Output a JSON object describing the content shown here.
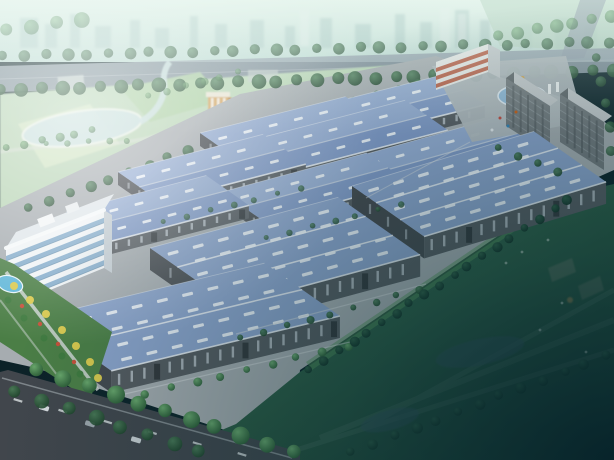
{
  "palette": {
    "sky_top": "#dcede6",
    "sky_mid": "#c0dcd5",
    "city_block": "#9fc0bd",
    "city_tower": "#e4eeea",
    "road_top": "#93a0ac",
    "road_median": "#b3bcc4",
    "road_asphalt": "#41464c",
    "lane_dash": "#d5dadc",
    "curb": "#d8dcdf",
    "park_base": "#b7d4b4",
    "field_pale": "#cfe3c0",
    "field_mid": "#a9cd9f",
    "field_light": "#dcead0",
    "lake": "#c6dedd",
    "shore": "#e9f1e7",
    "park_path": "#d5ddd3",
    "tower_front": "#d2a159",
    "tower_side": "#b5813f",
    "ground": "#a6acb0",
    "plaza": "#b2b9be",
    "roof_light": "#95acd2",
    "roof_dark": "#8099c6",
    "roof_big": "#8ba3cb",
    "roof_line": "#e8edf3",
    "ridge": "#c3cfe0",
    "skylight": "#eef3f9",
    "wall": "#565b60",
    "wall_dark": "#45494e",
    "wall_window": "#b6bec6",
    "door": "#34383c",
    "lawn_hi": "#549158",
    "lawn_light": "#4c8852",
    "lawn_mid": "#2d5c44",
    "lawn_dark": "#123129",
    "hq_white": "#eff3f5",
    "hq_glass": "#7fa9c8",
    "hq_glass_line": "#5e87a5",
    "hq_side": "#c5ced4",
    "hq_roof": "#dfe6ea",
    "entrance_white": "#e9eae8",
    "entrance_red": "#bb6047",
    "entrance_roof": "#d8dcde",
    "entrance_side": "#c4c9cc",
    "dorm_front": "#72787c",
    "dorm_side": "#5e6468",
    "dorm_roof": "#c3c7ca",
    "dorm_line": "#8e969b",
    "dorm_window": "#565c60",
    "fountain_ring": "#8fb8d8",
    "fountain_water": "#aecde6",
    "fountain_gold": "#cfa34f",
    "pool": "#5fb6d8",
    "garden": "#4b7e46",
    "walkway": "#cdd4d1",
    "tree_yellow": "#d9c94e",
    "tree_red": "#c7503a",
    "tree_green": "#3f7a3f",
    "pond_dark": "#2e5056",
    "hint_bldg": "#5f6f5f",
    "hint_orange": "#b98a4f",
    "dark_corner": "#05202a"
  },
  "background": {
    "city_blocks": [
      [
        20,
        18,
        18,
        30
      ],
      [
        45,
        24,
        12,
        24
      ],
      [
        70,
        14,
        10,
        34
      ],
      [
        95,
        26,
        16,
        22
      ],
      [
        130,
        20,
        10,
        28
      ],
      [
        155,
        28,
        14,
        20
      ],
      [
        190,
        16,
        8,
        32
      ],
      [
        215,
        24,
        12,
        24
      ],
      [
        250,
        20,
        14,
        28
      ],
      [
        285,
        26,
        10,
        22
      ],
      [
        320,
        18,
        12,
        30
      ],
      [
        355,
        24,
        16,
        24
      ],
      [
        395,
        14,
        10,
        34
      ],
      [
        420,
        22,
        12,
        26
      ],
      [
        455,
        10,
        14,
        38
      ],
      [
        480,
        20,
        10,
        28
      ],
      [
        520,
        24,
        12,
        24
      ],
      [
        555,
        18,
        14,
        30
      ],
      [
        585,
        26,
        12,
        22
      ]
    ],
    "city_towers": [
      [
        440,
        8,
        10,
        40
      ],
      [
        458,
        14,
        8,
        34
      ],
      [
        300,
        10,
        9,
        36
      ]
    ]
  },
  "park": {
    "fields": [
      {
        "pts": "18,124 90,104 120,144 45,168",
        "color": "field_pale"
      },
      {
        "pts": "120,88 200,72 225,100 150,122",
        "color": "field_mid"
      },
      {
        "pts": "175,132 260,110 285,152 200,176",
        "color": "field_light"
      }
    ],
    "lake": {
      "cx": 82,
      "cy": 128,
      "rx": 60,
      "ry": 17,
      "rot": -8
    },
    "pond": {
      "cx": 38,
      "cy": 200,
      "rx": 16,
      "ry": 6,
      "rot": -6
    },
    "river": "M140,122 C158,112 166,96 164,82 C163,74 166,66 170,62"
  },
  "warehouses": [
    {
      "id": "warehouse-back-right",
      "x": 318,
      "y": 106,
      "len": 128,
      "wid": 52,
      "h": 13,
      "slope": -0.25,
      "bays": 0
    },
    {
      "id": "warehouse-back-left",
      "x": 200,
      "y": 133,
      "len": 150,
      "wid": 52,
      "h": 13,
      "slope": -0.25,
      "bays": 0
    },
    {
      "id": "warehouse-row2-right",
      "x": 260,
      "y": 138,
      "len": 150,
      "wid": 52,
      "h": 13,
      "slope": -0.26,
      "bays": 0
    },
    {
      "id": "warehouse-row2-left",
      "x": 118,
      "y": 172,
      "len": 150,
      "wid": 52,
      "h": 13,
      "slope": -0.26,
      "bays": 0
    },
    {
      "id": "warehouse-row3-right",
      "x": 352,
      "y": 158,
      "len": 150,
      "wid": 54,
      "h": 14,
      "slope": -0.28,
      "bays": 0
    },
    {
      "id": "warehouse-row3-mid",
      "x": 222,
      "y": 192,
      "len": 150,
      "wid": 52,
      "h": 13,
      "slope": -0.27,
      "bays": 0
    },
    {
      "id": "warehouse-row3-left",
      "x": 66,
      "y": 212,
      "len": 145,
      "wid": 52,
      "h": 13,
      "slope": -0.26,
      "bays": 0
    },
    {
      "id": "warehouse-front-right",
      "x": 352,
      "y": 186,
      "len": 190,
      "wid": 88,
      "h": 22,
      "slope": -0.3,
      "bays": 2,
      "afterDorms": true
    },
    {
      "id": "warehouse-front-center",
      "x": 150,
      "y": 248,
      "len": 195,
      "wid": 100,
      "h": 22,
      "slope": -0.27,
      "bays": 2,
      "afterDorms": true
    },
    {
      "id": "warehouse-front-left",
      "x": 36,
      "y": 318,
      "len": 235,
      "wid": 92,
      "h": 22,
      "slope": -0.24,
      "bays": 1,
      "afterDorms": true
    }
  ],
  "tree_rows": [
    {
      "layer": "back",
      "x1": 4,
      "y1": 56,
      "x2": 610,
      "y2": 42,
      "n": 30,
      "r": 5.5,
      "tone": "dark",
      "op": 0.75
    },
    {
      "layer": "back",
      "x1": 2,
      "y1": 90,
      "x2": 612,
      "y2": 70,
      "n": 32,
      "r": 6.5,
      "tone": "dark",
      "op": 0.9
    },
    {
      "layer": "back",
      "x1": 500,
      "y1": 36,
      "x2": 610,
      "y2": 16,
      "n": 7,
      "r": 6,
      "tone": "light",
      "op": 0.6
    },
    {
      "layer": "back",
      "x1": 8,
      "y1": 30,
      "x2": 80,
      "y2": 20,
      "n": 4,
      "r": 7,
      "tone": "light",
      "op": 0.55
    },
    {
      "layer": "back",
      "x1": 30,
      "y1": 208,
      "x2": 268,
      "y2": 122,
      "n": 13,
      "r": 5,
      "tone": "dark",
      "op": 0.9
    },
    {
      "layer": "back",
      "x1": 268,
      "y1": 122,
      "x2": 420,
      "y2": 84,
      "n": 8,
      "r": 4.5,
      "tone": "dark",
      "op": 0.85
    },
    {
      "layer": "back",
      "x1": 8,
      "y1": 148,
      "x2": 92,
      "y2": 130,
      "n": 6,
      "r": 4,
      "tone": "light",
      "op": 0.7
    },
    {
      "layer": "back",
      "x1": 150,
      "y1": 96,
      "x2": 238,
      "y2": 72,
      "n": 6,
      "r": 3.5,
      "tone": "light",
      "op": 0.6
    },
    {
      "layer": "back",
      "x1": 48,
      "y1": 144,
      "x2": 128,
      "y2": 140,
      "n": 5,
      "r": 3,
      "tone": "light",
      "op": 0.65
    },
    {
      "layer": "front",
      "x1": 165,
      "y1": 222,
      "x2": 300,
      "y2": 188,
      "n": 7,
      "r": 3,
      "tone": "dark",
      "op": 0.8
    },
    {
      "layer": "front",
      "x1": 268,
      "y1": 238,
      "x2": 400,
      "y2": 204,
      "n": 7,
      "r": 3,
      "tone": "dark",
      "op": 0.8
    },
    {
      "layer": "front",
      "x1": 242,
      "y1": 338,
      "x2": 420,
      "y2": 290,
      "n": 9,
      "r": 3.5,
      "tone": "dark",
      "op": 0.9
    },
    {
      "layer": "front",
      "x1": 120,
      "y1": 400,
      "x2": 348,
      "y2": 346,
      "n": 10,
      "r": 4,
      "tone": "light",
      "op": 0.95
    },
    {
      "layer": "front",
      "x1": 310,
      "y1": 370,
      "x2": 568,
      "y2": 200,
      "n": 19,
      "r": 4.5,
      "tone": "deep",
      "op": 0.95
    },
    {
      "layer": "front",
      "x1": 500,
      "y1": 148,
      "x2": 556,
      "y2": 172,
      "n": 4,
      "r": 4,
      "tone": "dark",
      "op": 0.9
    },
    {
      "layer": "front",
      "x1": 598,
      "y1": 58,
      "x2": 612,
      "y2": 150,
      "n": 5,
      "r": 5,
      "tone": "dark",
      "op": 0.8
    },
    {
      "layer": "front",
      "x1": 38,
      "y1": 370,
      "x2": 292,
      "y2": 452,
      "n": 11,
      "r": 8,
      "tone": "light",
      "op": 1
    },
    {
      "layer": "front",
      "x1": 16,
      "y1": 392,
      "x2": 200,
      "y2": 452,
      "n": 8,
      "r": 7,
      "tone": "dark",
      "op": 0.9
    },
    {
      "layer": "front",
      "x1": 352,
      "y1": 452,
      "x2": 606,
      "y2": 356,
      "n": 13,
      "r": 5,
      "tone": "deep",
      "op": 0.8
    }
  ],
  "garden": {
    "yellow": [
      [
        14,
        286
      ],
      [
        30,
        300
      ],
      [
        46,
        314
      ],
      [
        62,
        330
      ],
      [
        76,
        346
      ],
      [
        90,
        362
      ],
      [
        98,
        378
      ]
    ],
    "red": [
      [
        22,
        306
      ],
      [
        40,
        324
      ],
      [
        58,
        344
      ],
      [
        74,
        362
      ]
    ],
    "green": [
      [
        8,
        300
      ],
      [
        24,
        318
      ],
      [
        44,
        338
      ],
      [
        62,
        356
      ],
      [
        80,
        374
      ]
    ]
  },
  "vehicles": {
    "road_cars": [
      {
        "x": 40,
        "y": 404,
        "c": "#d8dde0"
      },
      {
        "x": 86,
        "y": 420,
        "c": "#9fa8ae"
      },
      {
        "x": 132,
        "y": 436,
        "c": "#ccd2d6"
      }
    ],
    "rot": 17,
    "lane_dash": {
      "x1": 14,
      "y1": 398,
      "x2": 238,
      "y2": 452,
      "n": 6
    },
    "entrance_dots": [
      [
        500,
        118,
        "#c0392b"
      ],
      [
        508,
        126,
        "#2980b9"
      ],
      [
        492,
        130,
        "#e8ecef"
      ],
      [
        516,
        112,
        "#d35400"
      ]
    ],
    "lawn_dots": [
      [
        522,
        252
      ],
      [
        548,
        240
      ],
      [
        506,
        263
      ],
      [
        562,
        303
      ],
      [
        586,
        352
      ],
      [
        540,
        330
      ]
    ]
  },
  "dark_area": {
    "ponds": [
      {
        "cx": 480,
        "cy": 352,
        "rx": 45,
        "ry": 13,
        "rot": -12
      },
      {
        "cx": 390,
        "cy": 420,
        "rx": 30,
        "ry": 10,
        "rot": -15
      }
    ],
    "hints": [
      {
        "pts": "548,268 572,258 576,272 552,282",
        "color": "hint_bldg",
        "op": 0.5
      },
      {
        "pts": "578,286 600,276 604,290 582,300",
        "color": "hint_bldg",
        "op": 0.45
      }
    ]
  }
}
